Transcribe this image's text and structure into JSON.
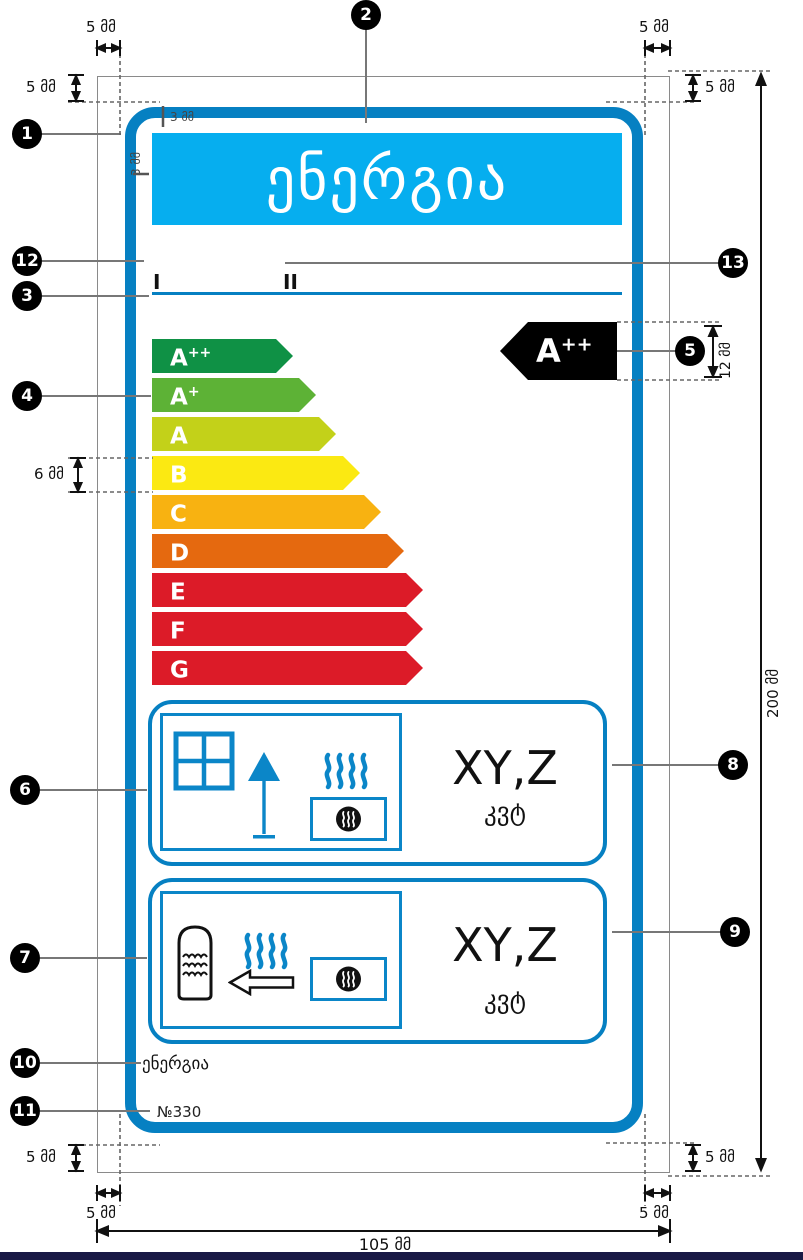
{
  "title": "Energy label layout specification",
  "header": {
    "title": "ენერგია",
    "bg": "#06AEEF"
  },
  "regions": {
    "i": "I",
    "ii": "II"
  },
  "energy_scale": {
    "classes": [
      {
        "base": "A",
        "sup": "++",
        "color": "#0F9145"
      },
      {
        "base": "A",
        "sup": "+",
        "color": "#5DB236"
      },
      {
        "base": "A",
        "sup": "",
        "color": "#C3D119"
      },
      {
        "base": "B",
        "sup": "",
        "color": "#FBE912"
      },
      {
        "base": "C",
        "sup": "",
        "color": "#F8B211"
      },
      {
        "base": "D",
        "sup": "",
        "color": "#E5690F"
      },
      {
        "base": "E",
        "sup": "",
        "color": "#DC1B28"
      },
      {
        "base": "F",
        "sup": "",
        "color": "#DC1B28"
      },
      {
        "base": "G",
        "sup": "",
        "color": "#DC1B28"
      }
    ],
    "indicator": {
      "base": "A",
      "sup": "++",
      "color": "#000000"
    }
  },
  "consumption": {
    "space_heating": {
      "value": "XY,Z",
      "unit": "კვტ"
    },
    "water_heating": {
      "value": "XY,Z",
      "unit": "კვტ"
    }
  },
  "footer": {
    "energy_word": "ენერგია",
    "regulation": "№330"
  },
  "dims": {
    "mm5": "5 მმ",
    "mm3": "3 მმ",
    "mm6": "6 მმ",
    "mm12": "12 მმ",
    "mm105": "105 მმ",
    "mm200": "200 მმ"
  },
  "callouts": [
    "1",
    "2",
    "3",
    "4",
    "5",
    "6",
    "7",
    "8",
    "9",
    "10",
    "11",
    "12",
    "13"
  ],
  "icons": [
    "window-icon",
    "lamp-icon",
    "heat-waves-icon",
    "burner-icon",
    "water-tank-icon",
    "arrow-left-icon"
  ],
  "colors": {
    "label_border": "#0680C2",
    "pictogram_blue": "#0B86C8",
    "header_bg": "#06AEEF",
    "edge_strip": "#191945",
    "leader_gray": "#777777"
  }
}
